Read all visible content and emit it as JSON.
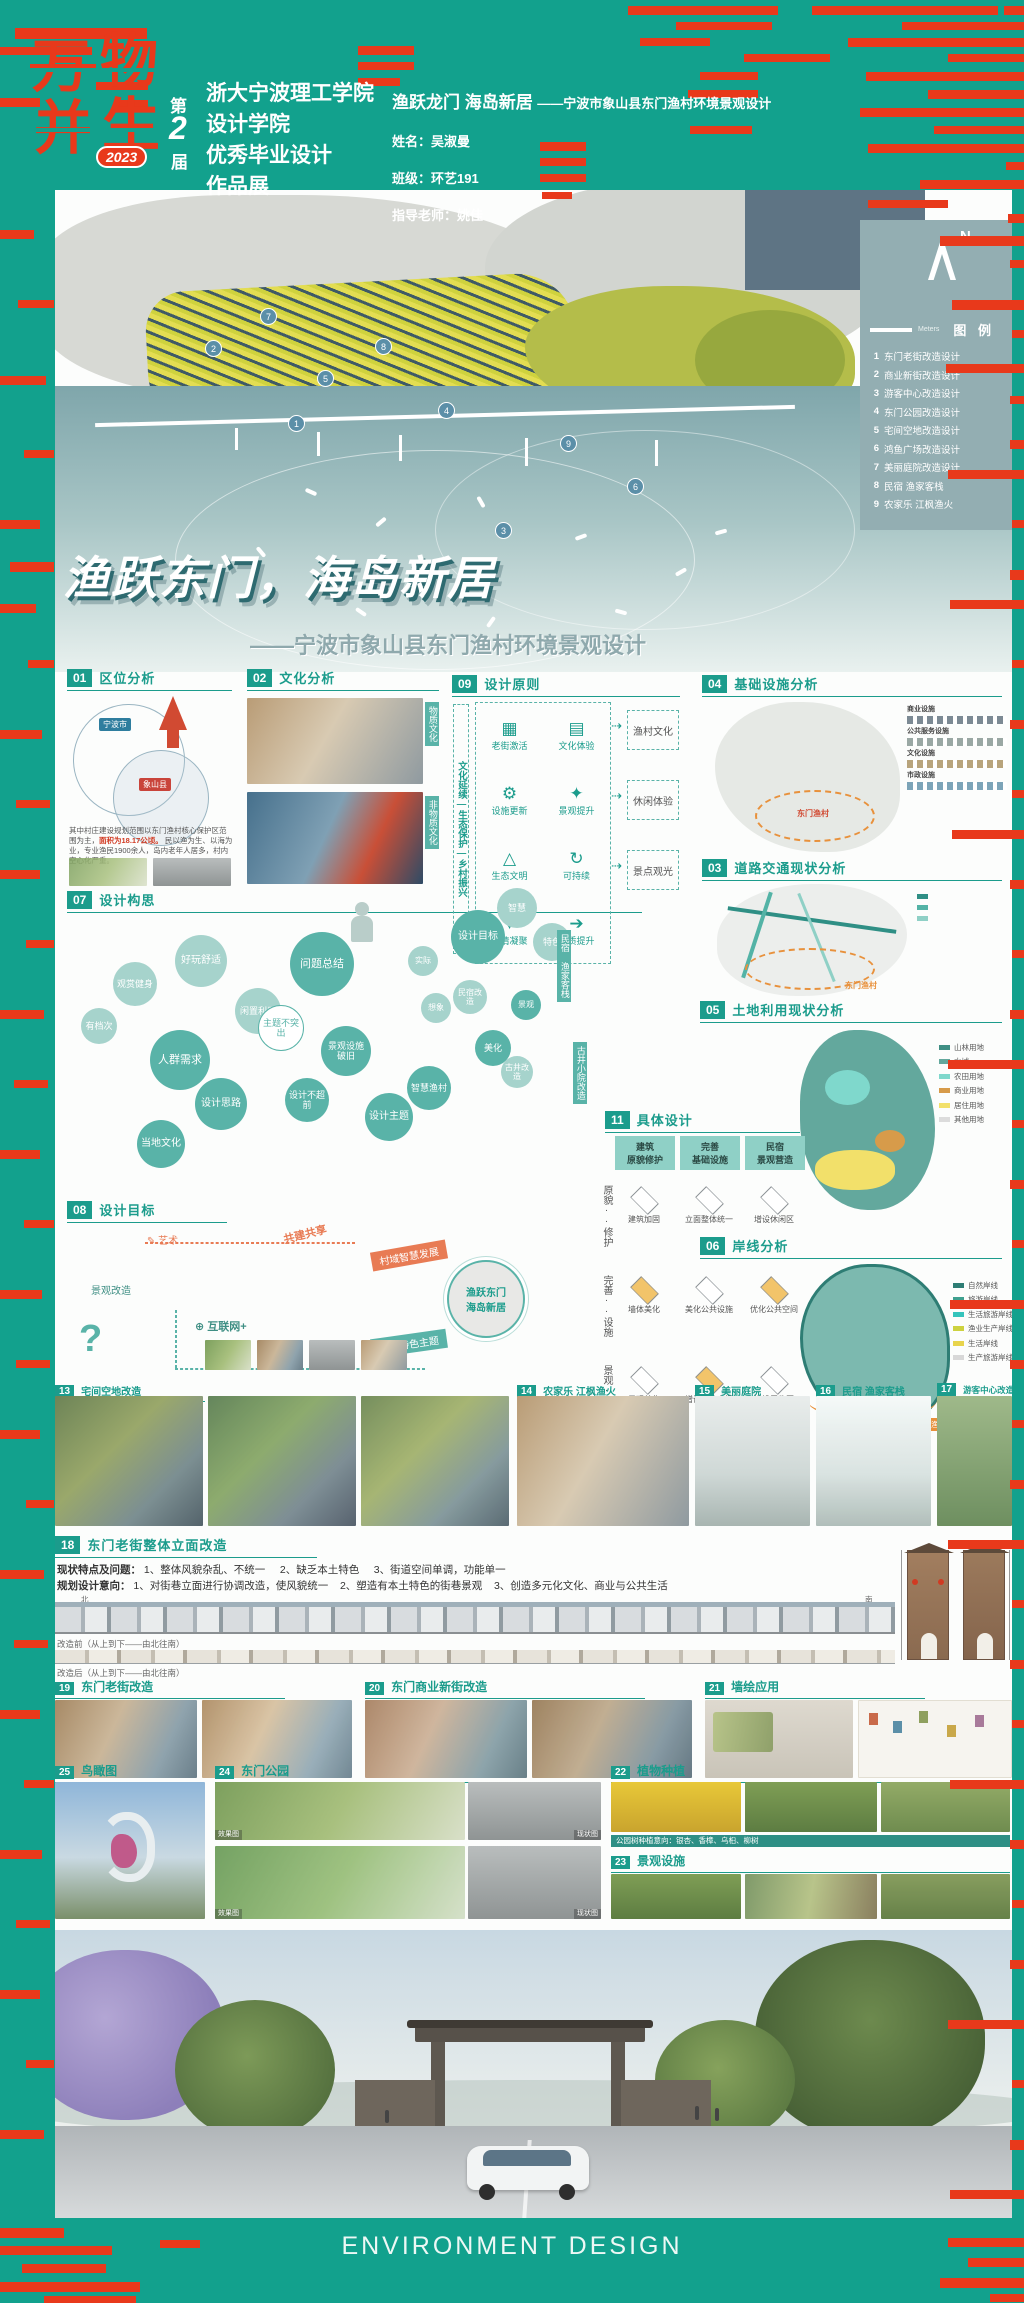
{
  "colors": {
    "background_teal": "#12A18D",
    "glitch_red": "#E8391B",
    "accent_teal": "#1B9C8C",
    "sea": "#7FA6AB",
    "legend_panel": "#93AEB2",
    "boundary_orange": "#E8913C"
  },
  "header": {
    "logo": {
      "c1": "万",
      "c2": "物",
      "c3": "并",
      "c4": "生",
      "year": "2023",
      "ed1": "第",
      "ed2": "2",
      "ed3": "届"
    },
    "school": [
      "浙大宁波理工学院",
      "设计学院",
      "优秀毕业设计",
      "作品展"
    ],
    "project": {
      "title": "渔跃龙门 海岛新居",
      "subtitle": "——宁波市象山县东门渔村环境景观设计",
      "name": "姓名：吴淑曼",
      "clazz": "班级：环艺191",
      "advisor": "指导老师：姚佳"
    }
  },
  "map": {
    "north": "N",
    "scale": "Meters",
    "legend_title": "图 例",
    "legend_items": [
      {
        "num": "1",
        "label": "东门老街改造设计"
      },
      {
        "num": "2",
        "label": "商业新街改造设计"
      },
      {
        "num": "3",
        "label": "游客中心改造设计"
      },
      {
        "num": "4",
        "label": "东门公园改造设计"
      },
      {
        "num": "5",
        "label": "宅间空地改造设计"
      },
      {
        "num": "6",
        "label": "鸿鱼广场改造设计"
      },
      {
        "num": "7",
        "label": "美丽庭院改造设计"
      },
      {
        "num": "8",
        "label": "民宿 渔家客栈"
      },
      {
        "num": "9",
        "label": "农家乐 江枫渔火"
      }
    ],
    "markers": [
      "1",
      "2",
      "3",
      "4",
      "5",
      "6",
      "7",
      "8",
      "9"
    ]
  },
  "poster": {
    "main_title": "渔跃东门，海岛新居",
    "subtitle": "——宁波市象山县东门渔村环境景观设计"
  },
  "sections": {
    "s01": {
      "num": "01",
      "title": "区位分析"
    },
    "s02": {
      "num": "02",
      "title": "文化分析"
    },
    "s03": {
      "num": "03",
      "title": "道路交通现状分析"
    },
    "s04": {
      "num": "04",
      "title": "基础设施分析"
    },
    "s05": {
      "num": "05",
      "title": "土地利用现状分析"
    },
    "s06": {
      "num": "06",
      "title": "岸线分析"
    },
    "s07": {
      "num": "07",
      "title": "设计构思"
    },
    "s08": {
      "num": "08",
      "title": "设计目标"
    },
    "s09": {
      "num": "09",
      "title": "设计原则"
    },
    "s11": {
      "num": "11",
      "title": "具体设计"
    },
    "s13": {
      "num": "13",
      "title": "宅间空地改造"
    },
    "s14": {
      "num": "14",
      "title": "农家乐 江枫渔火"
    },
    "s15": {
      "num": "15",
      "title": "美丽庭院"
    },
    "s16": {
      "num": "16",
      "title": "民宿 渔家客栈"
    },
    "s17": {
      "num": "17",
      "title": "游客中心改造"
    },
    "s18": {
      "num": "18",
      "title": "东门老街整体立面改造"
    },
    "s19": {
      "num": "19",
      "title": "东门老街改造"
    },
    "s20": {
      "num": "20",
      "title": "东门商业新街改造"
    },
    "s21": {
      "num": "21",
      "title": "墙绘应用"
    },
    "s22": {
      "num": "22",
      "title": "植物种植"
    },
    "s23": {
      "num": "23",
      "title": "景观设施"
    },
    "s24": {
      "num": "24",
      "title": "东门公园"
    },
    "s25": {
      "num": "25",
      "title": "鸟瞰图"
    }
  },
  "s01": {
    "city": "宁波市",
    "county": "象山县",
    "p1": "其中村庄建设规划范围以东门渔村核心保护区范围为主，",
    "p1red": "面积为18.17公顷。",
    "p2": "民以渔为生、以海为业，专业渔民1900余人，岛内老年人居多，村内空心化严重。"
  },
  "s02": {
    "tag1": "物质文化",
    "tag2": "非物质文化"
  },
  "s09": {
    "ribbon": "文化延续—生态保护—乡村振兴",
    "items": [
      "老街激活",
      "文化体验",
      "设施更新",
      "景观提升",
      "生态文明",
      "可持续",
      "乡情凝聚",
      "品质提升"
    ],
    "outputs": [
      "渔村文化",
      "休闲体验",
      "景点观光"
    ]
  },
  "s04": {
    "groups": [
      "商业设施",
      "公共服务设施",
      "文化设施",
      "市政设施"
    ],
    "village": "东门渔村"
  },
  "s03": {
    "village": "东门渔村"
  },
  "s05": {
    "legend": [
      "山林用地",
      "水域",
      "农田用地",
      "商业用地",
      "居住用地",
      "其他用地"
    ]
  },
  "s06": {
    "legend": [
      "自然岸线",
      "旅游岸线",
      "生活旅游岸线",
      "渔业生产岸线",
      "生活岸线",
      "生产旅游岸线"
    ],
    "village": "东门渔村"
  },
  "s07": {
    "bubbles": [
      "问题总结",
      "人群需求",
      "设计思路",
      "当地文化",
      "好玩舒适",
      "观赏健身",
      "有档次",
      "闲置利用",
      "主题不突出",
      "景观设施破旧",
      "设计不超前",
      "设计主题",
      "智慧渔村",
      "实际",
      "想象",
      "美化",
      "民宿改造",
      "古井改造",
      "景观",
      "设计目标",
      "智慧",
      "特色"
    ],
    "ribbon1": "民宿 渔家客栈",
    "ribbon2": "古井小院改造"
  },
  "s08": {
    "labels": [
      "共建共享",
      "艺术",
      "村域智慧发展",
      "互联网+",
      "景观改造",
      "自身特色主题"
    ],
    "center1": "渔跃东门",
    "center2": "海岛新居"
  },
  "s11": {
    "cols": [
      {
        "a": "建筑",
        "b": "原貌修护"
      },
      {
        "a": "完善",
        "b": "基础设施"
      },
      {
        "a": "民宿",
        "b": "景观营造"
      }
    ],
    "rows": [
      "原貌··修护",
      "完善··设施",
      "景观··营造"
    ],
    "cells": [
      [
        "建筑加固",
        "立面整体统一",
        "增设休闲区"
      ],
      [
        "墙体美化",
        "美化公共设施",
        "优化公共空间"
      ],
      [
        "景观美化",
        "增设商业空间",
        "增设展览区"
      ]
    ]
  },
  "s18": {
    "issues_label": "现状特点及问题：",
    "issues": [
      "1、整体风貌杂乱、不统一",
      "2、缺乏本土特色",
      "3、街道空间单调，功能单一"
    ],
    "intent_label": "规划设计意向：",
    "intent": [
      "1、对街巷立面进行协调改造，使风貌统一",
      "2、塑造有本土特色的街巷景观",
      "3、创造多元化文化、商业与公共生活"
    ],
    "before": "改造前（从上到下——由北往南）",
    "after": "改造后（从上到下——由北往南）",
    "north": "北",
    "south": "南"
  },
  "s22": {
    "caption": "公园树种植意向：银杏、香樟、乌桕、柳树"
  },
  "s24": {
    "effect": "效果图",
    "status": "现状图"
  },
  "footer": {
    "text": "ENVIRONMENT DESIGN"
  }
}
